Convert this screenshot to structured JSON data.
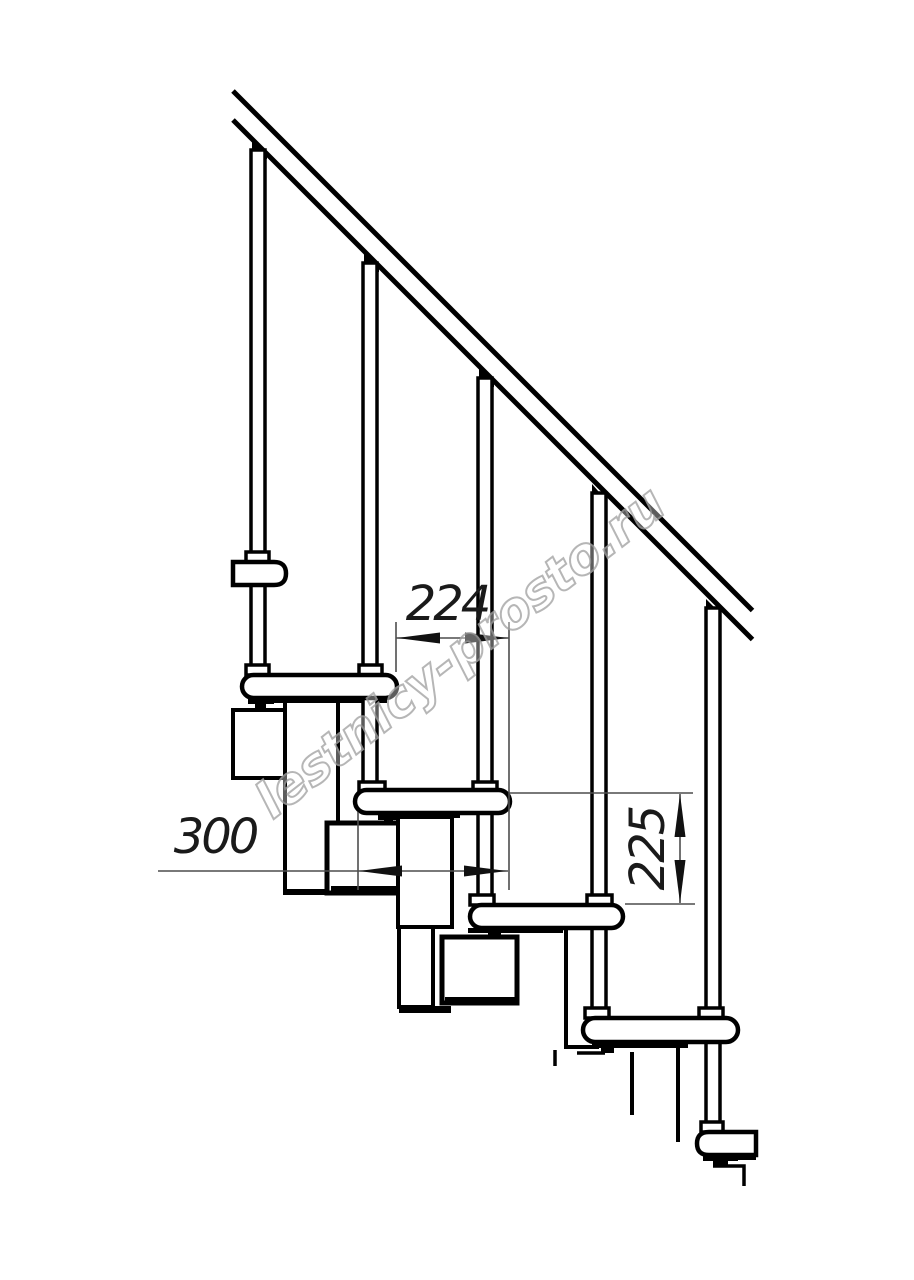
{
  "page": {
    "background": "#ffffff"
  },
  "drawing": {
    "line_color": "#000000",
    "dimension_color": "#4d4d4d",
    "watermark": {
      "text": "lestnicy-prosto.ru",
      "color": "#a5a5a5"
    },
    "dimensions": {
      "run_between_posts": {
        "value": "224"
      },
      "tread_depth": {
        "value": "300"
      },
      "rise": {
        "value": "225"
      }
    }
  }
}
